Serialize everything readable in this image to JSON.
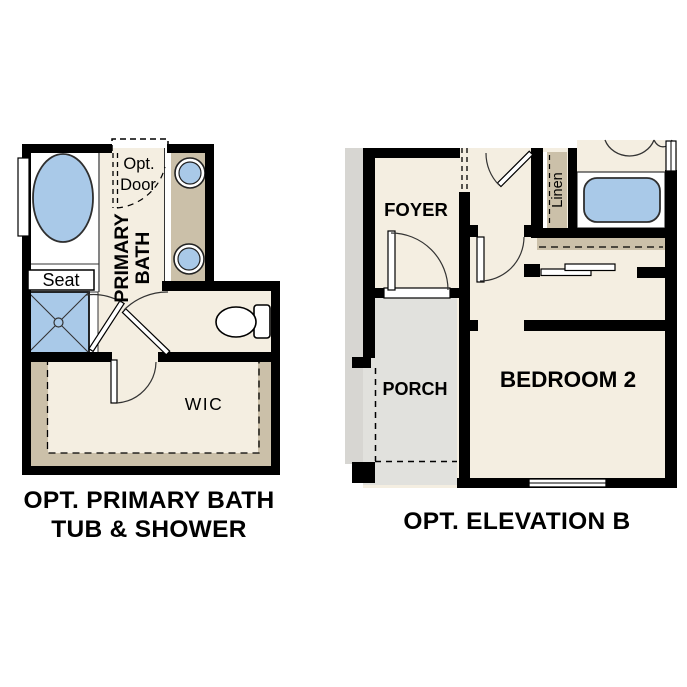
{
  "left_plan": {
    "title_line1": "OPT. PRIMARY BATH",
    "title_line2": "TUB & SHOWER",
    "labels": {
      "opt_door_line1": "Opt.",
      "opt_door_line2": "Door",
      "primary_bath_line1": "PRIMARY",
      "primary_bath_line2": "BATH",
      "seat": "Seat",
      "wic": "WIC"
    }
  },
  "right_plan": {
    "title": "OPT. ELEVATION B",
    "labels": {
      "foyer": "FOYER",
      "porch": "PORCH",
      "bedroom": "BEDROOM 2",
      "linen": "Linen"
    }
  },
  "colors": {
    "floor_cream": "#F4EEE1",
    "cabinet_tan": "#CBC0A9",
    "fixture_blue": "#A9C9E8",
    "porch_gray": "#E1E1DD",
    "outer_gray": "#D7D6D2",
    "wall_black": "#000000"
  }
}
